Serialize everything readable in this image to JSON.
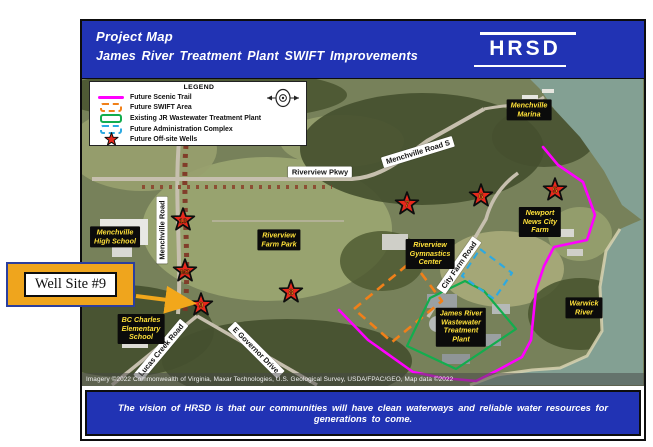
{
  "header": {
    "title_line1": "Project Map",
    "title_line2": "James River Treatment Plant SWIFT Improvements",
    "logo_text": "HRSD",
    "bar_color": "#2133b4"
  },
  "legend": {
    "title": "LEGEND",
    "items": [
      {
        "label": "Future Scenic Trail",
        "swatch": "line",
        "color": "#ff00ff"
      },
      {
        "label": "Future SWIFT Area",
        "swatch": "dashed",
        "color": "#f08019"
      },
      {
        "label": "Existing JR Wastewater Treatment Plant",
        "swatch": "solid",
        "color": "#13ad4e"
      },
      {
        "label": "Future Administration Complex",
        "swatch": "dashed",
        "color": "#2da9e1"
      },
      {
        "label": "Future Off-site Wells",
        "swatch": "star",
        "color": "#e8291c"
      }
    ],
    "compass_icon": "compass-rose"
  },
  "callout": {
    "label": "Well Site #9",
    "box_color": "#efa51d",
    "border_color": "#2b3f9e",
    "arrow_color": "#f2a71b"
  },
  "map": {
    "place_labels": [
      {
        "text": "Menchville\nHigh School",
        "x": 33,
        "y": 158
      },
      {
        "text": "Riverview\nFarm Park",
        "x": 197,
        "y": 161
      },
      {
        "text": "Menchville\nMarina",
        "x": 447,
        "y": 31
      },
      {
        "text": "Newport\nNews City\nFarm",
        "x": 458,
        "y": 143
      },
      {
        "text": "Riverview\nGymnastics\nCenter",
        "x": 348,
        "y": 175
      },
      {
        "text": "James River\nWastewater\nTreatment\nPlant",
        "x": 379,
        "y": 248
      },
      {
        "text": "Warwick\nRiver",
        "x": 502,
        "y": 229
      },
      {
        "text": "BC Charles\nElementary\nSchool",
        "x": 59,
        "y": 250
      }
    ],
    "road_labels": [
      {
        "text": "Riverview Pkwy",
        "x": 238,
        "y": 93,
        "rot": 0
      },
      {
        "text": "Menchville Road",
        "x": 80,
        "y": 151,
        "rot": -90
      },
      {
        "text": "Menchville Road S",
        "x": 336,
        "y": 73,
        "rot": -17
      },
      {
        "text": "City Farm Road",
        "x": 377,
        "y": 186,
        "rot": -55
      },
      {
        "text": "Lucas Creek Road",
        "x": 79,
        "y": 271,
        "rot": -50
      },
      {
        "text": "E Governor Drive",
        "x": 174,
        "y": 271,
        "rot": 45
      }
    ],
    "wells": [
      {
        "label": "10",
        "x": 101,
        "y": 141
      },
      {
        "label": "M2",
        "x": 103,
        "y": 192
      },
      {
        "label": "9",
        "x": 119,
        "y": 226
      },
      {
        "label": "8",
        "x": 209,
        "y": 213
      },
      {
        "label": "7",
        "x": 325,
        "y": 125
      },
      {
        "label": "6",
        "x": 399,
        "y": 117
      },
      {
        "label": "5",
        "x": 473,
        "y": 111
      }
    ],
    "star_number_color": "#ffa51e",
    "attribution": "Imagery ©2022 Commonwealth of Virginia, Maxar Technologies, U.S. Geological Survey, USDA/FPAC/GEO, Map data ©2022"
  },
  "footer": {
    "text": "The vision of HRSD is that our communities will have clean waterways and reliable water resources for generations to come."
  }
}
